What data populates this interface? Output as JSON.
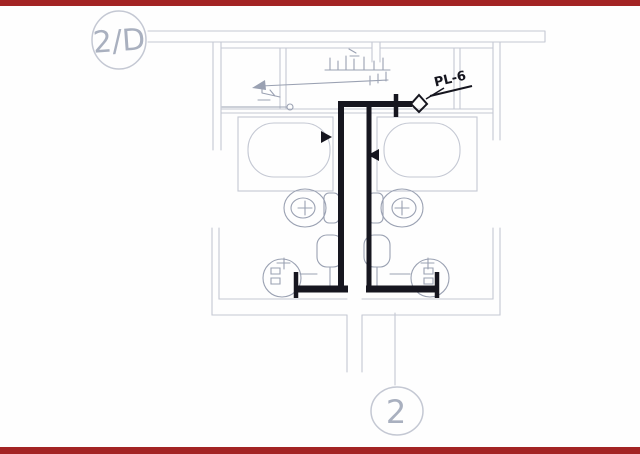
{
  "markers": {
    "top": "2/D",
    "bottom": "2"
  },
  "pipe": {
    "label": "PL-6"
  },
  "colors": {
    "paper": "#fefefe",
    "bar": "#a32424",
    "pencil": "#c4c8d3",
    "sketch": "#9aa1b2",
    "ink": "#16161f",
    "label": "#a9b0bf"
  }
}
